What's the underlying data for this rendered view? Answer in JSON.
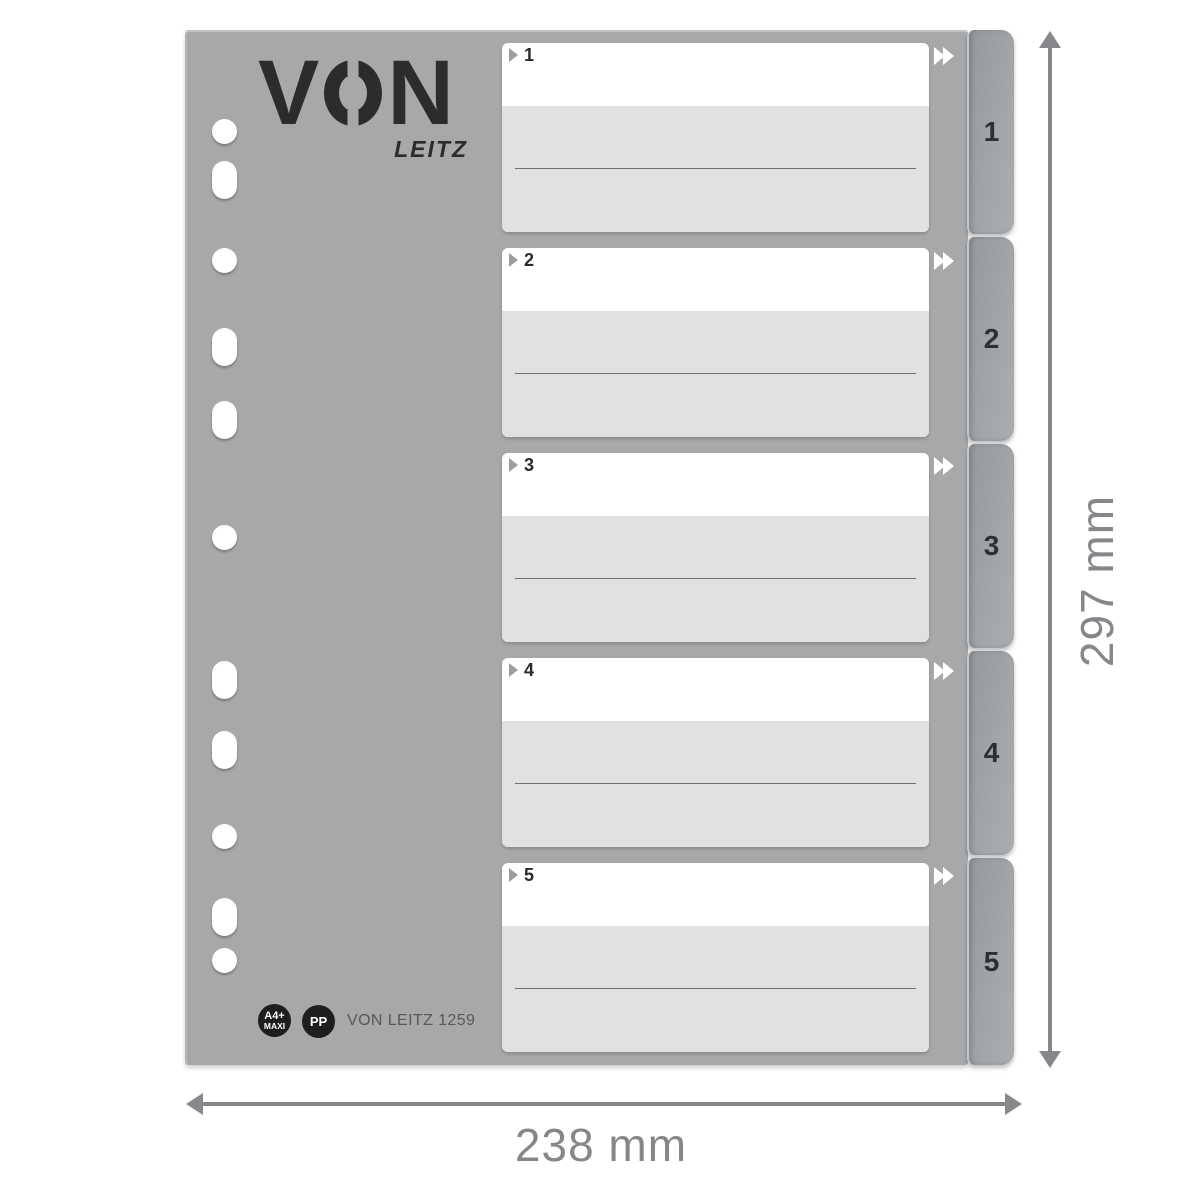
{
  "brand": {
    "name": "VON",
    "name_left": "V",
    "name_right": "N",
    "sub": "LEITZ"
  },
  "sections": [
    {
      "label": "1"
    },
    {
      "label": "2"
    },
    {
      "label": "3"
    },
    {
      "label": "4"
    },
    {
      "label": "5"
    }
  ],
  "tabs": [
    {
      "label": "1"
    },
    {
      "label": "2"
    },
    {
      "label": "3"
    },
    {
      "label": "4"
    },
    {
      "label": "5"
    }
  ],
  "footer": {
    "size_badge": {
      "line1": "A4+",
      "line2": "MAXI"
    },
    "material_badge": "PP",
    "product_code": "VON LEITZ 1259"
  },
  "dimensions": {
    "height": "297 mm",
    "width": "238 mm"
  },
  "punch_holes": [
    {
      "shape": "round",
      "center_y": 131
    },
    {
      "shape": "oblong",
      "center_y": 180
    },
    {
      "shape": "round",
      "center_y": 260
    },
    {
      "shape": "oblong",
      "center_y": 347
    },
    {
      "shape": "oblong",
      "center_y": 420
    },
    {
      "shape": "round",
      "center_y": 537
    },
    {
      "shape": "oblong",
      "center_y": 680
    },
    {
      "shape": "oblong",
      "center_y": 750
    },
    {
      "shape": "round",
      "center_y": 836
    },
    {
      "shape": "oblong",
      "center_y": 917
    },
    {
      "shape": "round",
      "center_y": 960
    }
  ],
  "colors": {
    "sheet_gray": "#a7a8aa",
    "tab_gray": "#9b9fa1",
    "card_white": "#ffffff",
    "card_gray": "#e0e1e3",
    "badge_black": "#1e1e1c",
    "logo_ink": "#2d2c2b",
    "dimension_gray": "#85878a"
  }
}
